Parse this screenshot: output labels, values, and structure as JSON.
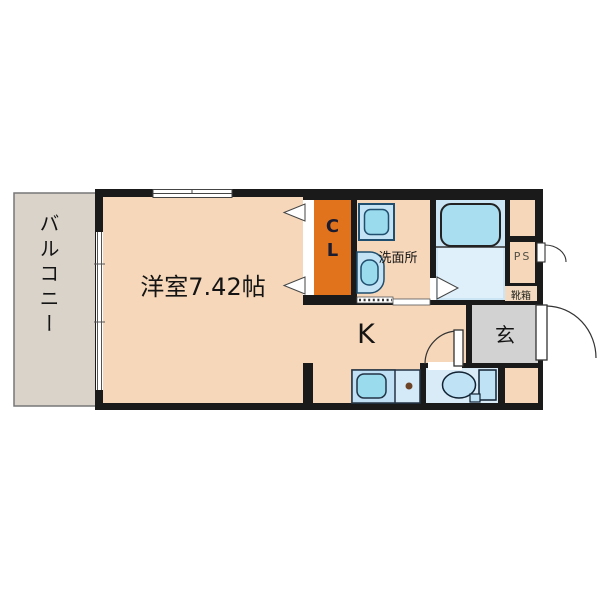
{
  "title": "apartment-floor-plan",
  "rooms": {
    "balcony": "バルコニー",
    "main_room": "洋室7.42帖",
    "closet": "CL",
    "washroom": "洗面所",
    "kitchen": "K",
    "entrance": "玄",
    "pipe_space": "PS",
    "shoe_box": "靴箱"
  },
  "colors": {
    "wall": "#1a1a1a",
    "floor_peach": "#f6d7ba",
    "closet_orange": "#e2731d",
    "balcony_gray": "#d9d3ca",
    "entrance_gray": "#d2d2d2",
    "bathroom_blue": "#cbe5f4",
    "bathroom_lower_blue": "#dff0fa",
    "tub_cyan": "#a9def1",
    "fixture_blue": "#bfe0f5",
    "fixture_light_blue": "#d5eaf8",
    "fixture_cyan": "#9adbee",
    "fixture_outline": "#1f4e6e",
    "toilet_room_blue": "#d9ebf7",
    "burner_brown": "#6e4428"
  }
}
